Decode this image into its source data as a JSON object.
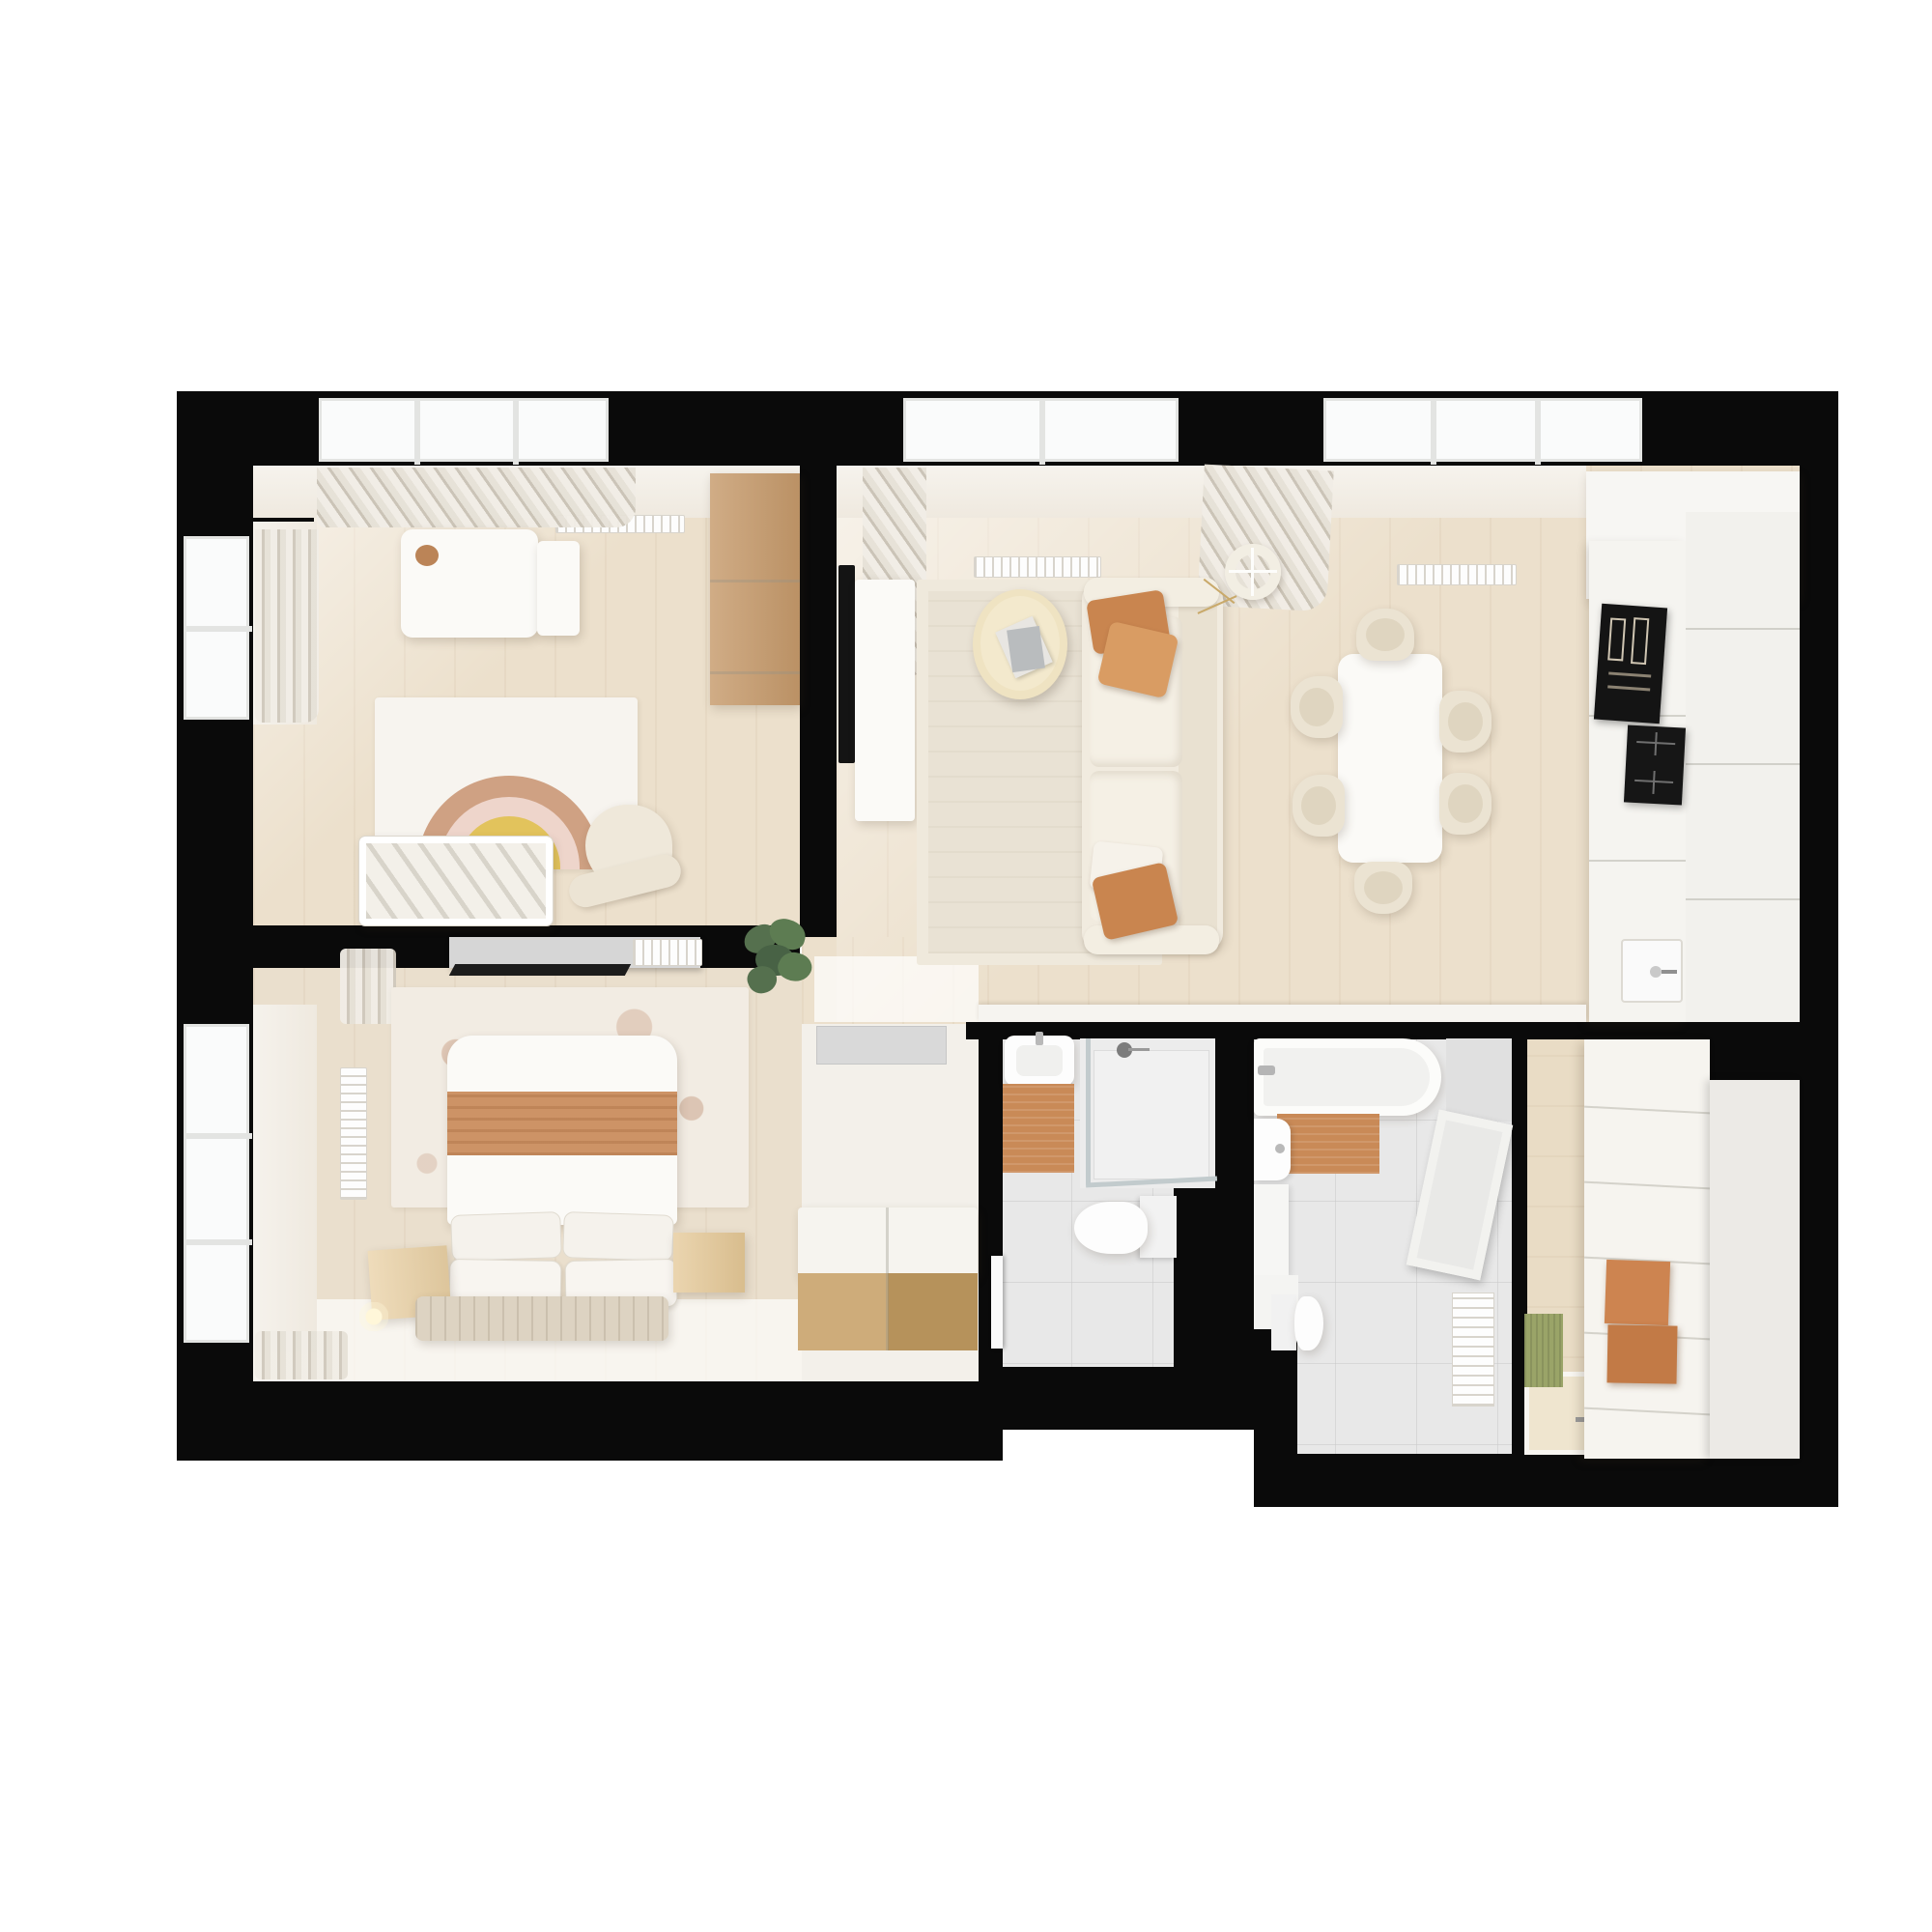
{
  "scene": {
    "alt": "Top-down 3D render of a furnished two-bedroom apartment floor plan",
    "background": "#ffffff",
    "wall_color": "#0a0a0a"
  },
  "palette": {
    "floor_wood": "#ece0cc",
    "floor_bright": "#f7f4ee",
    "bathroom_tile": "#e8e8e8",
    "furniture_wood": "#c69a6b",
    "terracotta": "#cd8a58",
    "terracotta_dark": "#c07a45",
    "cream_fabric": "#efe8da",
    "living_rug": "#e9e2d4",
    "nursery_rug": "#f7f4ef",
    "rainbow_tan": "#cfa183",
    "rainbow_pink": "#eed5cb",
    "rainbow_yellow": "#e2c35c",
    "rainbow_teal": "#a5c6b4",
    "plant_green": "#55704e",
    "doormat_green": "#9aa468",
    "doormat_gray": "#d9d9d9",
    "appliance_black": "#141414"
  },
  "rooms": [
    {
      "id": "nursery",
      "name": "Kids room"
    },
    {
      "id": "living",
      "name": "Living room with kitchen and dining area"
    },
    {
      "id": "bedroom",
      "name": "Bedroom"
    },
    {
      "id": "corridor",
      "name": "Inner corridor"
    },
    {
      "id": "bathroom_shower",
      "name": "Shower bathroom with WC"
    },
    {
      "id": "bathroom_tub",
      "name": "Bathroom with tub and WC"
    },
    {
      "id": "hallway",
      "name": "Entry hall with closet"
    }
  ],
  "furniture": {
    "nursery": [
      "changing table",
      "toy",
      "wooden wardrobe",
      "rainbow rug",
      "crib",
      "rocking chair",
      "window curtains",
      "radiator"
    ],
    "living": [
      "tv",
      "tv console",
      "area rug",
      "round coffee table",
      "magazines",
      "sofa",
      "terracotta cushions",
      "ring floor lamp",
      "dining table",
      "six dining chairs",
      "curtains",
      "radiators",
      "low ledge"
    ],
    "kitchen": [
      "tall cabinets",
      "built-in double oven",
      "induction cooktop",
      "sink with faucet"
    ],
    "bedroom": [
      "double bed with terracotta runner",
      "four pillows",
      "textured wall rug",
      "two wooden nightstands",
      "bedside lamp",
      "quilted foot bench",
      "media shelf with tv",
      "radiator grille",
      "potted plant",
      "window curtains"
    ],
    "corridor": [
      "gray doormat",
      "storage bench with wooden front",
      "bathroom door"
    ],
    "bathroom_shower": [
      "washbasin",
      "terracotta bath mat",
      "walk-in shower with glass",
      "wall-hung toilet"
    ],
    "bathroom_tub": [
      "bathtub with faucet",
      "terracotta bath mat",
      "washbasin with vanity",
      "toilet",
      "leaning mirror panel",
      "vertical radiator"
    ],
    "hallway": [
      "paneled closet",
      "tall wardrobe",
      "two terracotta storage boxes",
      "green doormat",
      "floor platform with hatch"
    ]
  }
}
